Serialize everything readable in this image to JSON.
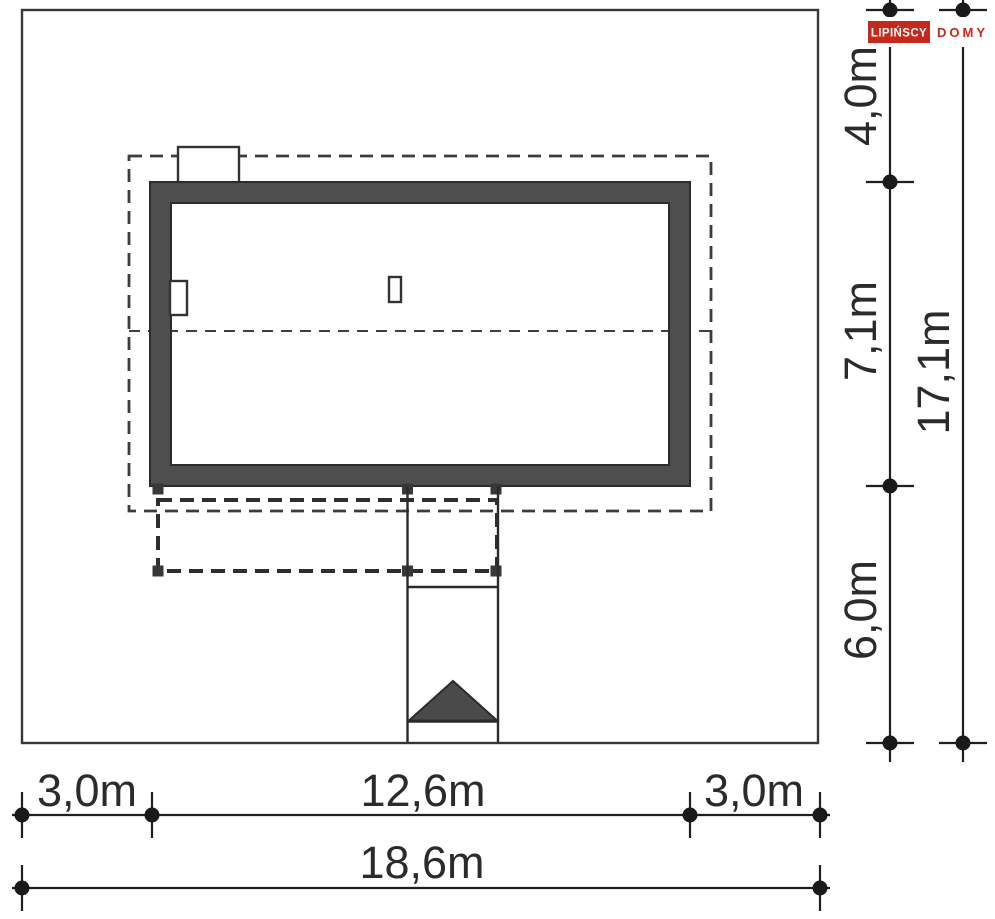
{
  "logo": {
    "name": "LIPIŃSCY",
    "suffix": "DOMY"
  },
  "dimensions": {
    "bottom": {
      "left_margin": "3,0m",
      "house_width": "12,6m",
      "right_margin": "3,0m",
      "total_width": "18,6m"
    },
    "right": {
      "top_margin": "4,0m",
      "house_depth": "7,1m",
      "bottom_margin": "6,0m",
      "total_depth": "17,1m"
    }
  },
  "colors": {
    "brand_red": "#c5281c",
    "wall_fill": "#4e4e4e",
    "dark_fill": "#4a4a4a",
    "line_dark": "#2b2b2b",
    "white": "#ffffff"
  }
}
